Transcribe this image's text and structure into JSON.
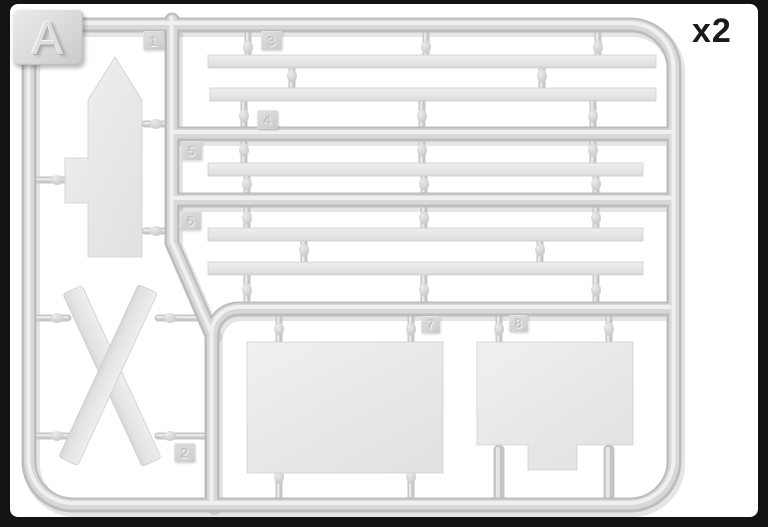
{
  "plate_letter": "A",
  "copies_label": "x2",
  "part_tags": {
    "t1": "1",
    "t2": "2",
    "t3": "3",
    "t4": "4",
    "t5": "5",
    "t6": "6",
    "t7": "7",
    "t8": "8"
  },
  "colors": {
    "background": "#131313",
    "page": "#ffffff",
    "plastic_part": "#e7e7e7",
    "runner": "#c9c9c9",
    "label_ink": "#1a1a1a"
  }
}
